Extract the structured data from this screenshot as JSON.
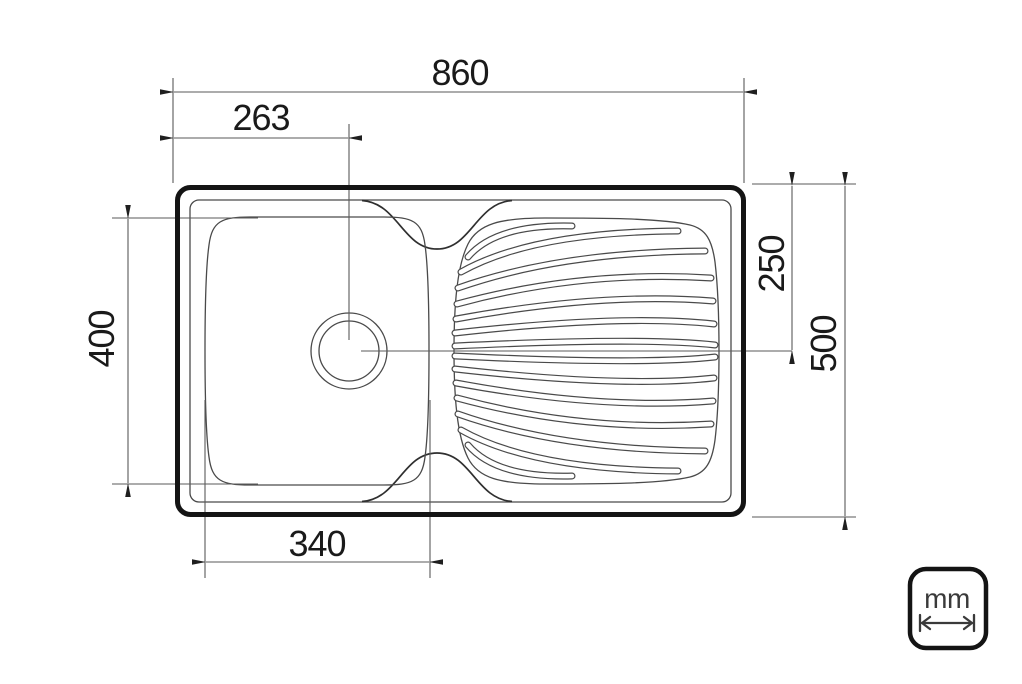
{
  "drawing": {
    "type": "technical-dimension-drawing",
    "subject": "kitchen sink top view with single bowl and drainboard",
    "dimensions": {
      "overall_width": "860",
      "drain_offset_x": "263",
      "bowl_width": "340",
      "bowl_depth": "400",
      "drain_offset_y": "250",
      "overall_depth": "500"
    },
    "unit_badge": {
      "label": "mm"
    },
    "colors": {
      "background": "#ffffff",
      "outline_heavy": "#141414",
      "outline_thin": "#4a4a4a",
      "dimension_lines": "#5a5a5a",
      "text": "#1a1a1a"
    }
  }
}
